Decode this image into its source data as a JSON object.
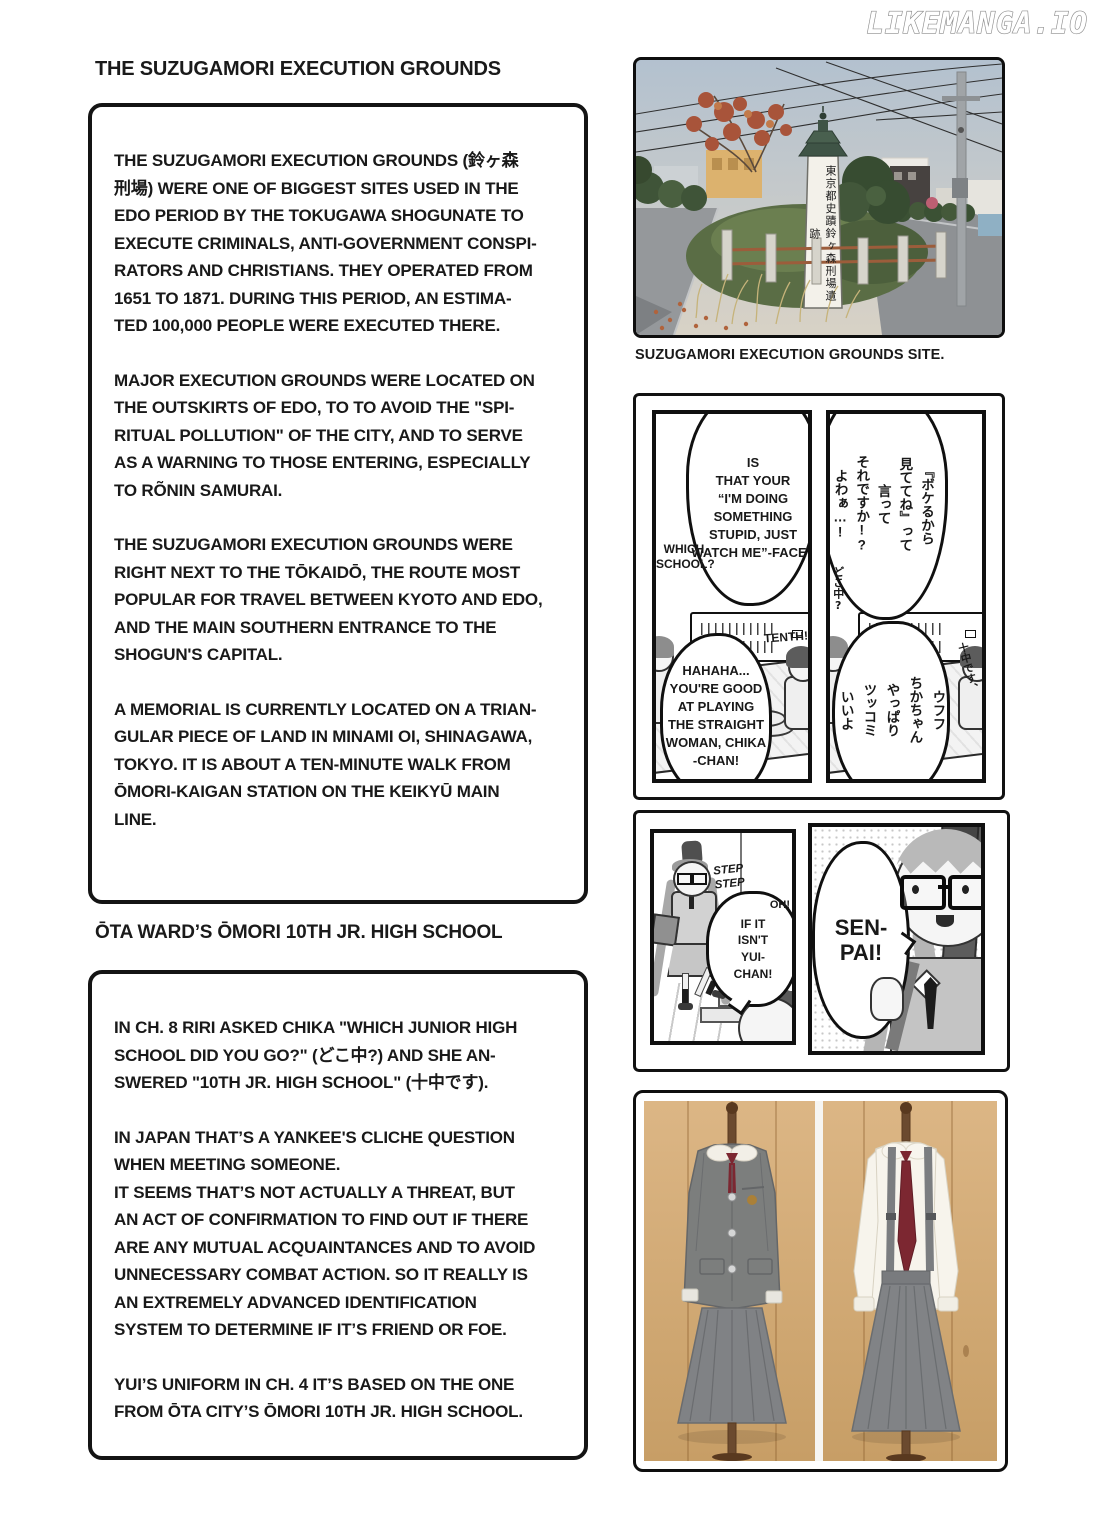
{
  "watermark": "LIKEMANGA.IO",
  "left": {
    "section1": {
      "heading": "THE SUZUGAMORI EXECUTION GROUNDS",
      "paragraphs": [
        "THE SUZUGAMORI EXECUTION GROUNDS (鈴ヶ森\n刑場) WERE ONE OF BIGGEST SITES USED IN THE\nEDO PERIOD BY THE TOKUGAWA SHOGUNATE TO\nEXECUTE CRIMINALS, ANTI-GOVERNMENT CONSPI-\nRATORS AND CHRISTIANS. THEY OPERATED FROM\n1651 TO 1871. DURING THIS PERIOD, AN ESTIMA-\nTED 100,000 PEOPLE WERE EXECUTED THERE.",
        "MAJOR EXECUTION GROUNDS WERE LOCATED ON\nTHE OUTSKIRTS OF EDO, TO TO AVOID THE \"SPI-\nRITUAL POLLUTION\" OF THE CITY, AND TO SERVE\nAS A WARNING TO THOSE ENTERING, ESPECIALLY\nTO RÕNIN SAMURAI.",
        "THE SUZUGAMORI EXECUTION GROUNDS WERE\nRIGHT NEXT TO THE TŌKAIDŌ, THE ROUTE MOST\nPOPULAR FOR TRAVEL BETWEEN KYOTO AND EDO,\nAND THE MAIN SOUTHERN ENTRANCE TO THE\nSHOGUN'S CAPITAL.",
        "A MEMORIAL IS CURRENTLY LOCATED ON A TRIAN-\nGULAR PIECE OF LAND IN MINAMI OI, SHINAGAWA,\nTOKYO. IT IS ABOUT A TEN-MINUTE WALK FROM\nŌMORI-KAIGAN STATION ON THE KEIKYŪ MAIN\nLINE."
      ]
    },
    "section2": {
      "heading": "ŌTA WARD’S ŌMORI 10TH JR. HIGH SCHOOL",
      "paragraphs": [
        "IN CH. 8 RIRI ASKED CHIKA \"WHICH JUNIOR HIGH\nSCHOOL DID YOU GO?\" (どこ中?) AND SHE AN-\nSWERED \"10TH JR. HIGH SCHOOL\" (十中です).",
        "IN JAPAN THAT’S A YANKEE'S CLICHE QUESTION\nWHEN MEETING SOMEONE.\nIT SEEMS THAT’S NOT ACTUALLY A THREAT, BUT\nAN ACT OF CONFIRMATION TO FIND OUT IF THERE\nARE ANY MUTUAL ACQUAINTANCES AND TO AVOID\nUNNECESSARY COMBAT ACTION. SO IT REALLY IS\nAN EXTREMELY ADVANCED IDENTIFICATION\nSYSTEM TO DETERMINE IF IT’S FRIEND OR FOE.",
        "YUI’S UNIFORM IN CH. 4 IT’S BASED ON THE ONE\nFROM ŌTA CITY’S ŌMORI 10TH JR. HIGH SCHOOL."
      ]
    }
  },
  "right": {
    "photo_caption": "SUZUGAMORI EXECUTION GROUNDS SITE.",
    "monument_inscription": "東京都史蹟鈴ヶ森刑場遺跡",
    "strip1": {
      "left_panel": {
        "top_bubble": "IS\nTHAT YOUR\n“I'M DOING\nSOMETHING\nSTUPID, JUST\nWATCH ME”-FACE?",
        "side_text": "WHICH\nSCHOOL?",
        "bottom_bubble": "HAHAHA...\nYOU'RE GOOD\nAT PLAYING\nTHE STRAIGHT\nWOMAN, CHIKA\n-CHAN!",
        "aside_text": "TENTH!"
      },
      "right_panel": {
        "top_bubble": "『ボケるから\n見ててね』って\n言って\nそれですか!?\nよわぁ…!",
        "side_text": "どこ中?",
        "bottom_bubble": "ウフフ\nちかちゃん\nやっぱり\nツッコミ\nいいよ",
        "aside_text": "十中です、"
      }
    },
    "strip2": {
      "left_panel": {
        "sfx": "STEP\nSTEP",
        "bubble_exclaim": "OH!",
        "bubble": "IF IT\nISN'T\nYUI-\nCHAN!"
      },
      "right_panel": {
        "bubble": "SEN-\nPAI!"
      }
    }
  },
  "colors": {
    "ink": "#1a1a1a",
    "paper": "#ffffff",
    "tie_red": "#7c2731",
    "uniform_gray": "#818386",
    "wood": "#d2a870",
    "sky": "#b7c3cf",
    "pagoda_roof_green": "#3f5446",
    "rail_rust": "#9c5d3b"
  }
}
